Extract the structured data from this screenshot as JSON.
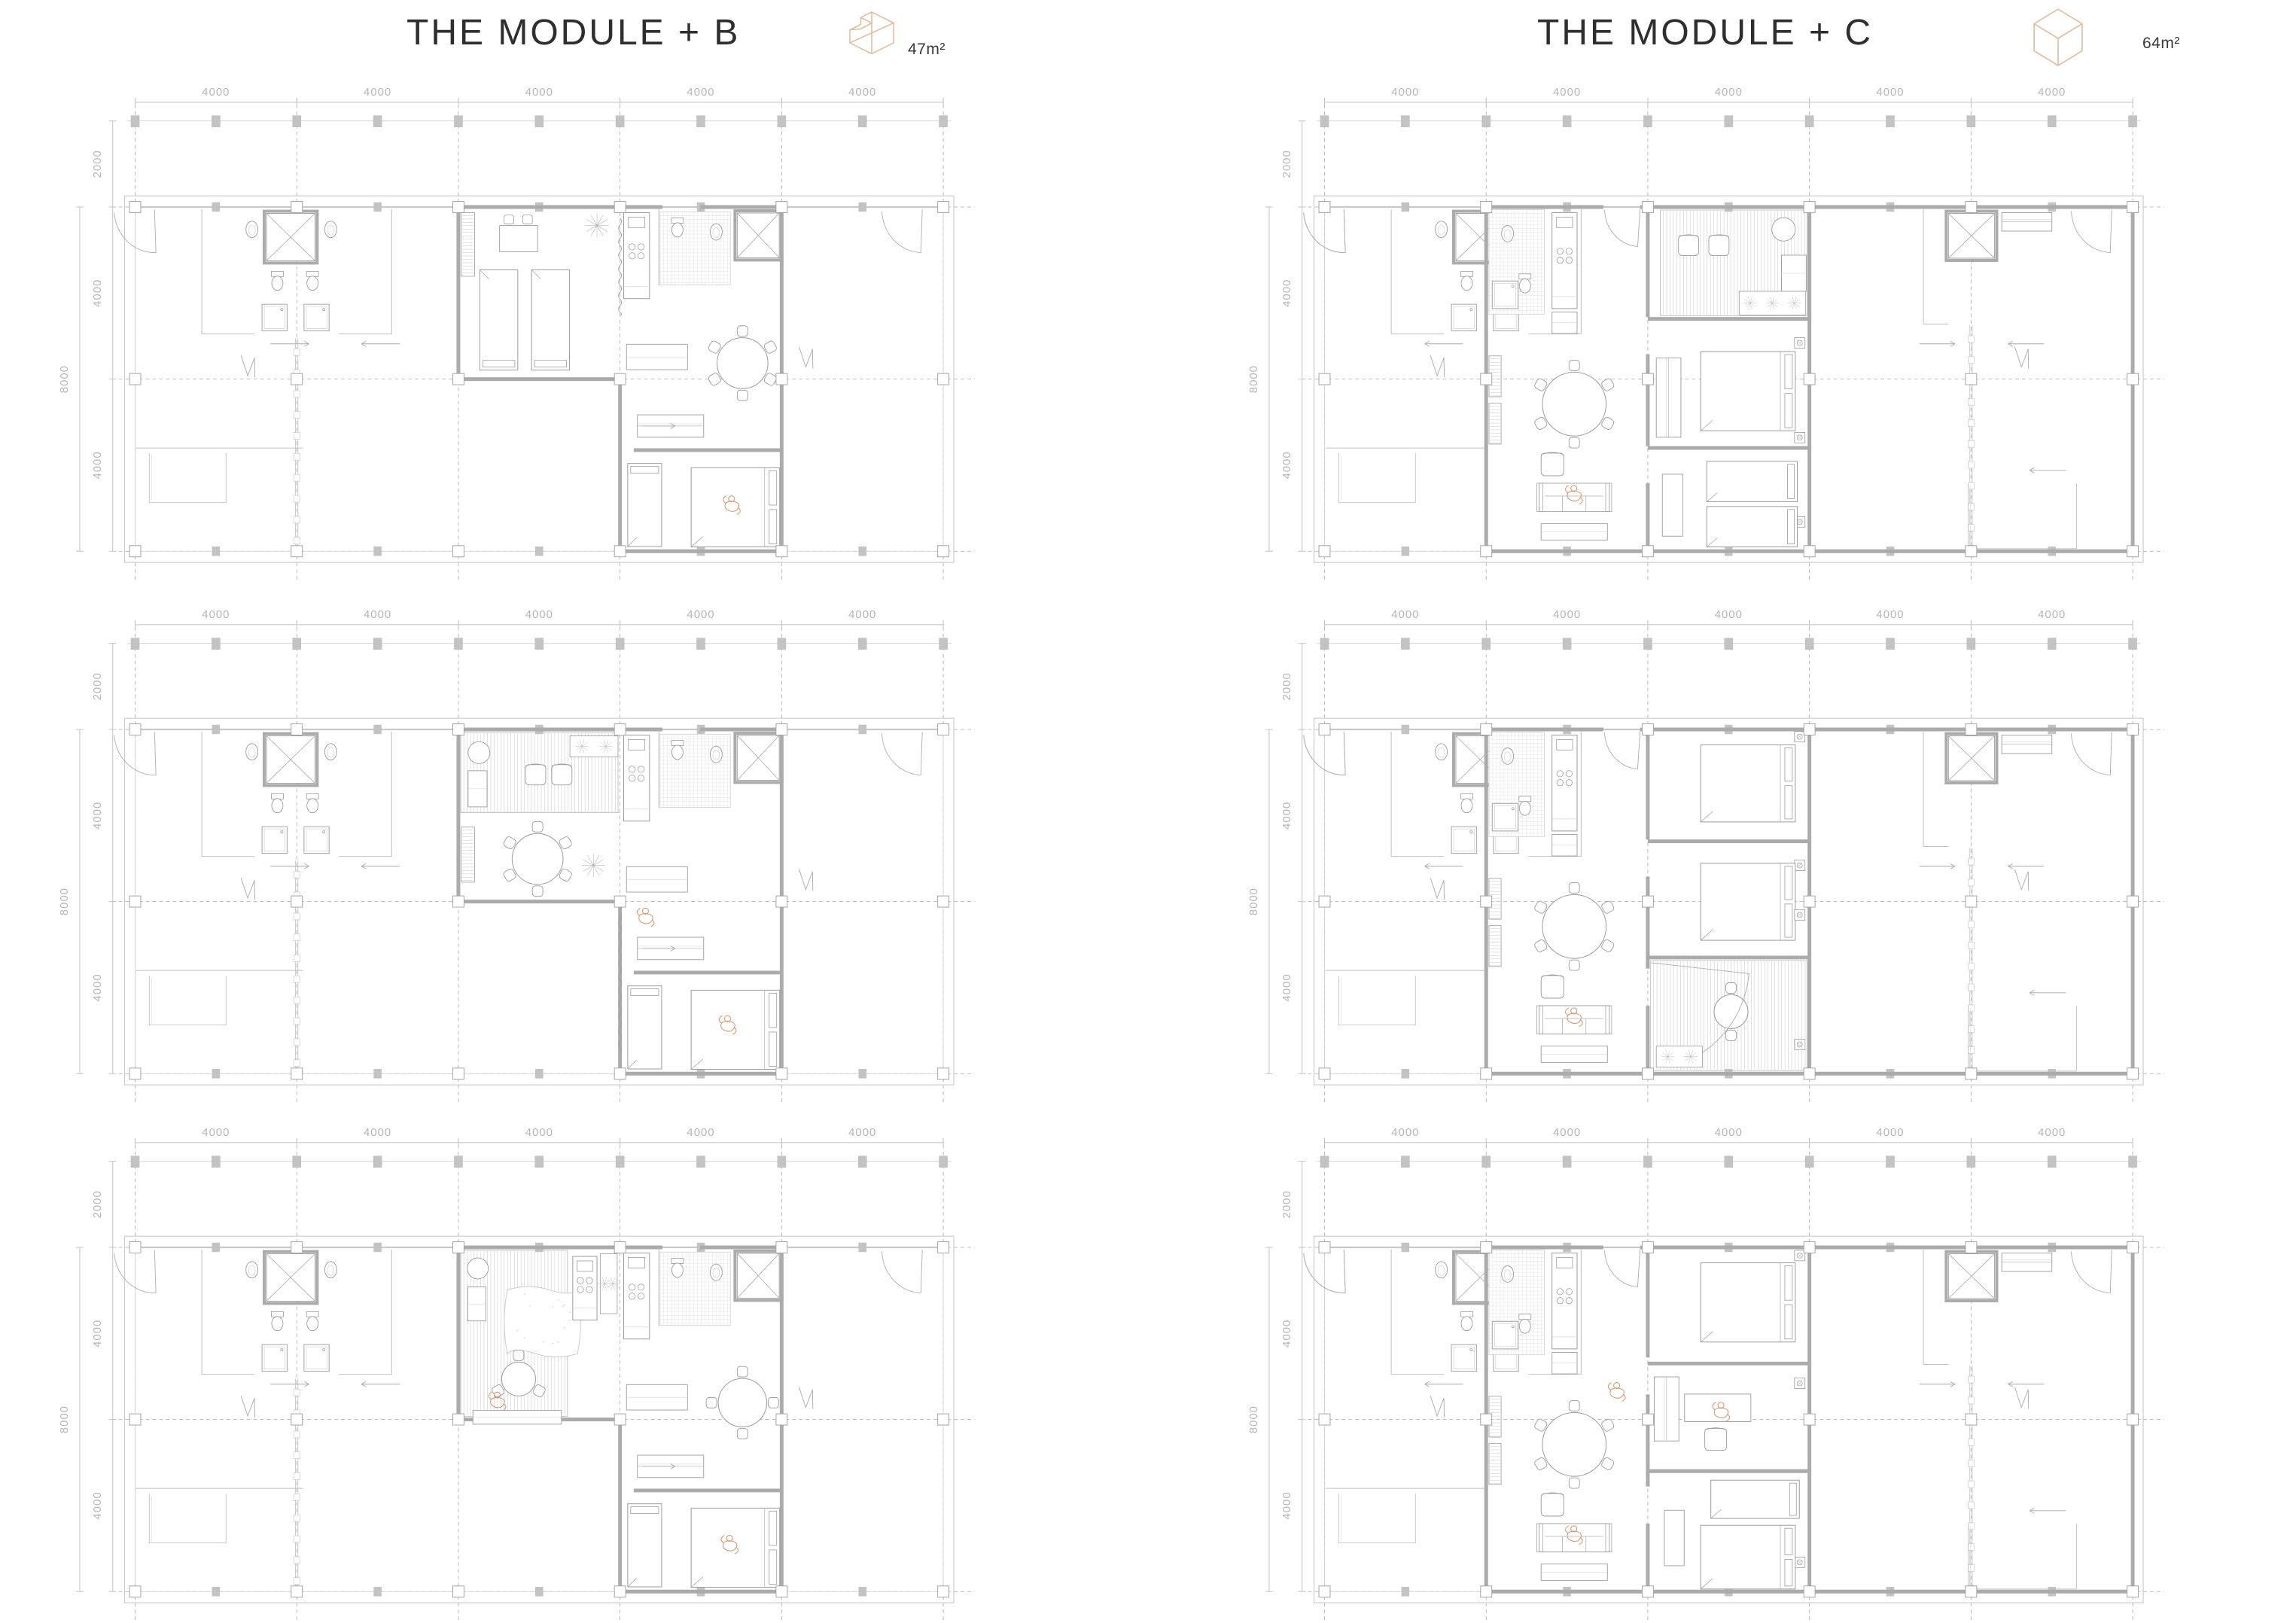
{
  "titles": {
    "left": "THE MODULE + B",
    "right": "THE MODULE + C"
  },
  "areas": {
    "left": "47m²",
    "right": "64m²"
  },
  "icons": {
    "left": "module-b-l-shaped-isometric-icon",
    "right": "module-c-box-isometric-icon"
  },
  "dimensions": {
    "top": [
      "4000",
      "4000",
      "4000",
      "4000",
      "4000"
    ],
    "side": [
      "2000",
      "4000",
      "4000"
    ],
    "side_overall": "8000"
  },
  "colors": {
    "title_text": "#2e2e2e",
    "dim_text": "#b5b5b5",
    "dim_line": "#c2c2c2",
    "dash_line": "#a9a9a9",
    "wall": "#ababab",
    "light_line": "#c6c6c6",
    "furniture_line": "#9b9b9b",
    "tile_line": "#e0e0e0",
    "column_fill": "#c3c3c3",
    "accent_orange": "#d8906a",
    "icon_tan": "#e3bda0"
  },
  "shared": {
    "left_core": [
      [
        "showerX",
        3250,
        150,
        1200,
        1100
      ],
      [
        "sinkK",
        2890,
        520
      ],
      [
        "sinkK",
        4840,
        520
      ],
      [
        "wc",
        3520,
        1720
      ],
      [
        "wc",
        4390,
        1720
      ],
      [
        "sinkSq",
        3140,
        2260,
        620,
        620
      ],
      [
        "sinkSq",
        4180,
        2260,
        620,
        620
      ],
      [
        "wallL",
        1650,
        50,
        1650,
        2950
      ],
      [
        "wallL",
        6350,
        50,
        6350,
        2950
      ],
      [
        "wallL",
        1650,
        2950,
        2950,
        2950
      ],
      [
        "wallL",
        5050,
        2950,
        6350,
        2950
      ],
      [
        "door",
        480,
        60,
        1000,
        88,
        176
      ],
      [
        "zig",
        2620,
        3450
      ]
    ],
    "b_side": [
      [
        "arrow",
        3350,
        3180,
        950,
        1
      ],
      [
        "arrow",
        5600,
        3180,
        950,
        -1
      ],
      [
        "pwall",
        4000,
        3050,
        8000
      ],
      [
        "wallL",
        20,
        5600,
        4150,
        5600
      ],
      [
        "closetU",
        350,
        5720,
        1900,
        1150
      ],
      [
        "door",
        19480,
        60,
        1000,
        92,
        178
      ],
      [
        "zig",
        16430,
        3250
      ]
    ],
    "b_apt": [
      [
        "wall",
        8000,
        0,
        8000,
        4000
      ],
      [
        "wall",
        8000,
        4000,
        12000,
        4000
      ],
      [
        "wall",
        12000,
        4000,
        12000,
        8000
      ],
      [
        "wall",
        12000,
        8000,
        16000,
        8000
      ],
      [
        "wall",
        16000,
        0,
        16000,
        8000
      ],
      [
        "wall",
        8000,
        0,
        13050,
        0
      ],
      [
        "wall",
        13980,
        0,
        16000,
        0
      ],
      [
        "door",
        13980,
        50,
        900,
        92,
        176
      ],
      [
        "wall",
        12340,
        5650,
        16000,
        5650
      ],
      [
        "kitchen",
        12090,
        130,
        640,
        2000
      ],
      [
        "tiles",
        12990,
        110,
        1740,
        1700
      ],
      [
        "wc",
        13420,
        480
      ],
      [
        "sinkK",
        14380,
        580
      ],
      [
        "showerX",
        14900,
        140,
        1040,
        1040
      ],
      [
        "wallL",
        12960,
        0,
        12960,
        1830
      ],
      [
        "bedS",
        12190,
        5960,
        840,
        1930,
        0
      ],
      [
        "bedD",
        13760,
        6060,
        2190,
        1840,
        1
      ],
      [
        "ward",
        12430,
        4830,
        1640,
        520
      ],
      [
        "arrow",
        12560,
        5090,
        800,
        1
      ]
    ],
    "c_side": [
      [
        "arrow",
        2480,
        3180,
        950,
        -1
      ],
      [
        "wallL",
        20,
        5600,
        3950,
        5600
      ],
      [
        "closetU",
        350,
        5720,
        1900,
        1150
      ],
      [
        "door",
        480,
        60,
        1000,
        88,
        176
      ],
      [
        "showerX",
        15440,
        150,
        1140,
        1040
      ],
      [
        "ward",
        16760,
        130,
        1240,
        430
      ],
      [
        "door",
        19480,
        60,
        1000,
        92,
        178
      ],
      [
        "zig",
        17080,
        3250
      ],
      [
        "arrow",
        14720,
        3180,
        880,
        1
      ],
      [
        "arrow",
        16920,
        3180,
        880,
        -1
      ],
      [
        "pwall",
        16000,
        2750,
        8000
      ],
      [
        "closetU",
        15930,
        6420,
        2680,
        1520
      ],
      [
        "arrow",
        17450,
        6120,
        900,
        -1
      ],
      [
        "wallL",
        14820,
        50,
        14820,
        2720
      ],
      [
        "wallL",
        14820,
        2720,
        15440,
        2720
      ],
      [
        "wall",
        20000,
        0,
        20000,
        8000
      ],
      [
        "wall",
        4000,
        8000,
        20000,
        8000
      ],
      [
        "wall",
        12000,
        0,
        20000,
        0
      ]
    ],
    "c_apt": [
      [
        "wall",
        4000,
        0,
        4000,
        8000
      ],
      [
        "wall",
        4000,
        0,
        6900,
        0
      ],
      [
        "wall",
        7810,
        0,
        12000,
        0
      ],
      [
        "door",
        7810,
        40,
        880,
        94,
        178
      ],
      [
        "wall",
        12000,
        0,
        12000,
        8000
      ],
      [
        "wall",
        8000,
        0,
        8000,
        2560
      ],
      [
        "wall",
        8000,
        3420,
        8000,
        5560
      ],
      [
        "wall",
        8000,
        6420,
        8000,
        8000
      ],
      [
        "tiles",
        4070,
        60,
        1370,
        2430
      ],
      [
        "sinkSq",
        4150,
        1720,
        640,
        640
      ],
      [
        "wc",
        4960,
        1780
      ],
      [
        "sinkK",
        4530,
        620
      ],
      [
        "kitchen",
        5630,
        130,
        620,
        2230
      ],
      [
        "counter",
        5630,
        2440,
        620,
        500
      ],
      [
        "shelf",
        4070,
        3460,
        300,
        950
      ],
      [
        "shelf",
        4070,
        4560,
        300,
        950
      ],
      [
        "tableR",
        6180,
        4580,
        790,
        6
      ],
      [
        "chair1",
        5360,
        5720,
        560
      ],
      [
        "sofa",
        5310,
        6420,
        1740,
        660
      ],
      [
        "counter",
        5360,
        7360,
        1640,
        380
      ],
      [
        "fig",
        6170,
        6680
      ],
      [
        "vent",
        11760,
        3160
      ],
      [
        "vent",
        11760,
        7320
      ]
    ]
  },
  "plans": [
    {
      "id": "module-b-plan-1",
      "cell": "cell-b1",
      "include": [
        "left_core",
        "b_side",
        "b_apt"
      ],
      "items": [
        [
          "shelf",
          8070,
          130,
          330,
          1480
        ],
        [
          "tableS",
          9020,
          430,
          940,
          610
        ],
        [
          "plant",
          11430,
          430,
          300
        ],
        [
          "curt",
          12000,
          260,
          2520
        ],
        [
          "bedS",
          8530,
          1460,
          940,
          2330,
          2
        ],
        [
          "bedS",
          9810,
          1460,
          940,
          2330,
          2
        ],
        [
          "counter",
          12160,
          3190,
          1510,
          590
        ],
        [
          "tableR",
          15030,
          3630,
          630,
          6
        ],
        [
          "fig",
          14760,
          6920
        ]
      ]
    },
    {
      "id": "module-c-plan-1",
      "cell": "cell-c1",
      "include": [
        "left_core",
        "c_side",
        "c_apt"
      ],
      "items": [
        [
          "wall",
          8000,
          2600,
          12000,
          2600
        ],
        [
          "wall",
          8000,
          5600,
          12000,
          5600
        ],
        [
          "deck",
          8310,
          70,
          3630,
          2460
        ],
        [
          "chair1",
          8760,
          660,
          500
        ],
        [
          "chair1",
          9510,
          660,
          500
        ],
        [
          "basin",
          11360,
          520,
          290
        ],
        [
          "counter",
          11310,
          1120,
          610,
          840
        ],
        [
          "planter",
          10260,
          1960,
          1640,
          550
        ],
        [
          "bedD",
          9310,
          3360,
          2340,
          1840,
          1
        ],
        [
          "bedS",
          9460,
          5910,
          2240,
          940,
          1
        ],
        [
          "bedS",
          9460,
          6960,
          2240,
          940,
          1
        ],
        [
          "desk",
          8360,
          6210,
          510,
          1440
        ],
        [
          "ward",
          8210,
          3510,
          610,
          1840
        ],
        [
          "vent",
          11760,
          5360
        ]
      ]
    },
    {
      "id": "module-b-plan-2",
      "cell": "cell-b2",
      "include": [
        "left_core",
        "b_side",
        "b_apt"
      ],
      "items": [
        [
          "deck",
          8060,
          70,
          3890,
          1860
        ],
        [
          "basin",
          8510,
          540,
          270
        ],
        [
          "counter",
          8240,
          960,
          470,
          840
        ],
        [
          "chair1",
          9660,
          820,
          500
        ],
        [
          "chair1",
          10310,
          820,
          500
        ],
        [
          "planter",
          10760,
          150,
          1190,
          490
        ],
        [
          "wallL",
          8060,
          1930,
          12000,
          1930
        ],
        [
          "tableR",
          9960,
          3010,
          630,
          6
        ],
        [
          "plant",
          11340,
          3160,
          290
        ],
        [
          "shelf",
          8070,
          2270,
          330,
          1280
        ],
        [
          "fig",
          12630,
          4360
        ],
        [
          "counter",
          12160,
          3190,
          1510,
          590
        ],
        [
          "curt",
          12000,
          4260,
          7480
        ],
        [
          "fig",
          14660,
          6860
        ]
      ]
    },
    {
      "id": "module-c-plan-2",
      "cell": "cell-c2",
      "include": [
        "left_core",
        "c_side",
        "c_apt"
      ],
      "items": [
        [
          "wall",
          8000,
          2600,
          12000,
          2600
        ],
        [
          "wall",
          8000,
          5300,
          12000,
          5300
        ],
        [
          "bedD",
          9310,
          360,
          2340,
          1790,
          1
        ],
        [
          "vent",
          11760,
          170
        ],
        [
          "bedD",
          9310,
          3110,
          2340,
          1790,
          1
        ],
        [
          "deck",
          8070,
          5370,
          3870,
          2560
        ],
        [
          "tableR",
          10060,
          6560,
          420,
          2
        ],
        [
          "door",
          8070,
          5420,
          2450,
          6,
          82
        ],
        [
          "planter",
          8210,
          7360,
          1140,
          490
        ],
        [
          "vent",
          11760,
          4310
        ]
      ]
    },
    {
      "id": "module-b-plan-3",
      "cell": "cell-b3",
      "include": [
        "left_core",
        "b_side",
        "b_apt"
      ],
      "items": [
        [
          "deck",
          8060,
          70,
          2640,
          3860
        ],
        [
          "basin",
          8480,
          490,
          260
        ],
        [
          "counter",
          8230,
          920,
          450,
          790
        ],
        [
          "rug",
          9210,
          920,
          1740,
          1480
        ],
        [
          "planter",
          11510,
          150,
          420,
          1390
        ],
        [
          "kitchen",
          10830,
          210,
          600,
          1480
        ],
        [
          "tableR",
          9490,
          3060,
          420,
          3
        ],
        [
          "counter",
          8360,
          3790,
          2190,
          320
        ],
        [
          "fig",
          8960,
          3570
        ],
        [
          "tableR",
          15030,
          3610,
          600,
          4
        ],
        [
          "counter",
          12160,
          3190,
          1510,
          590
        ],
        [
          "fig",
          14710,
          6900
        ]
      ]
    },
    {
      "id": "module-c-plan-3",
      "cell": "cell-c3",
      "include": [
        "left_core",
        "c_side",
        "c_apt"
      ],
      "items": [
        [
          "wall",
          8000,
          2700,
          12000,
          2700
        ],
        [
          "wall",
          8000,
          5200,
          12000,
          5200
        ],
        [
          "bedD",
          9310,
          360,
          2340,
          1840,
          1
        ],
        [
          "vent",
          11760,
          190
        ],
        [
          "ward",
          8160,
          3010,
          610,
          1490
        ],
        [
          "desk",
          8910,
          3410,
          1640,
          640
        ],
        [
          "chair1",
          9410,
          4210,
          540
        ],
        [
          "fig",
          9810,
          3810
        ],
        [
          "bedS",
          9560,
          5410,
          2190,
          890,
          1
        ],
        [
          "desk",
          8410,
          6110,
          490,
          1290
        ],
        [
          "bedD",
          9310,
          6460,
          2340,
          1480,
          1
        ],
        [
          "fig",
          7230,
          3350
        ]
      ]
    }
  ]
}
